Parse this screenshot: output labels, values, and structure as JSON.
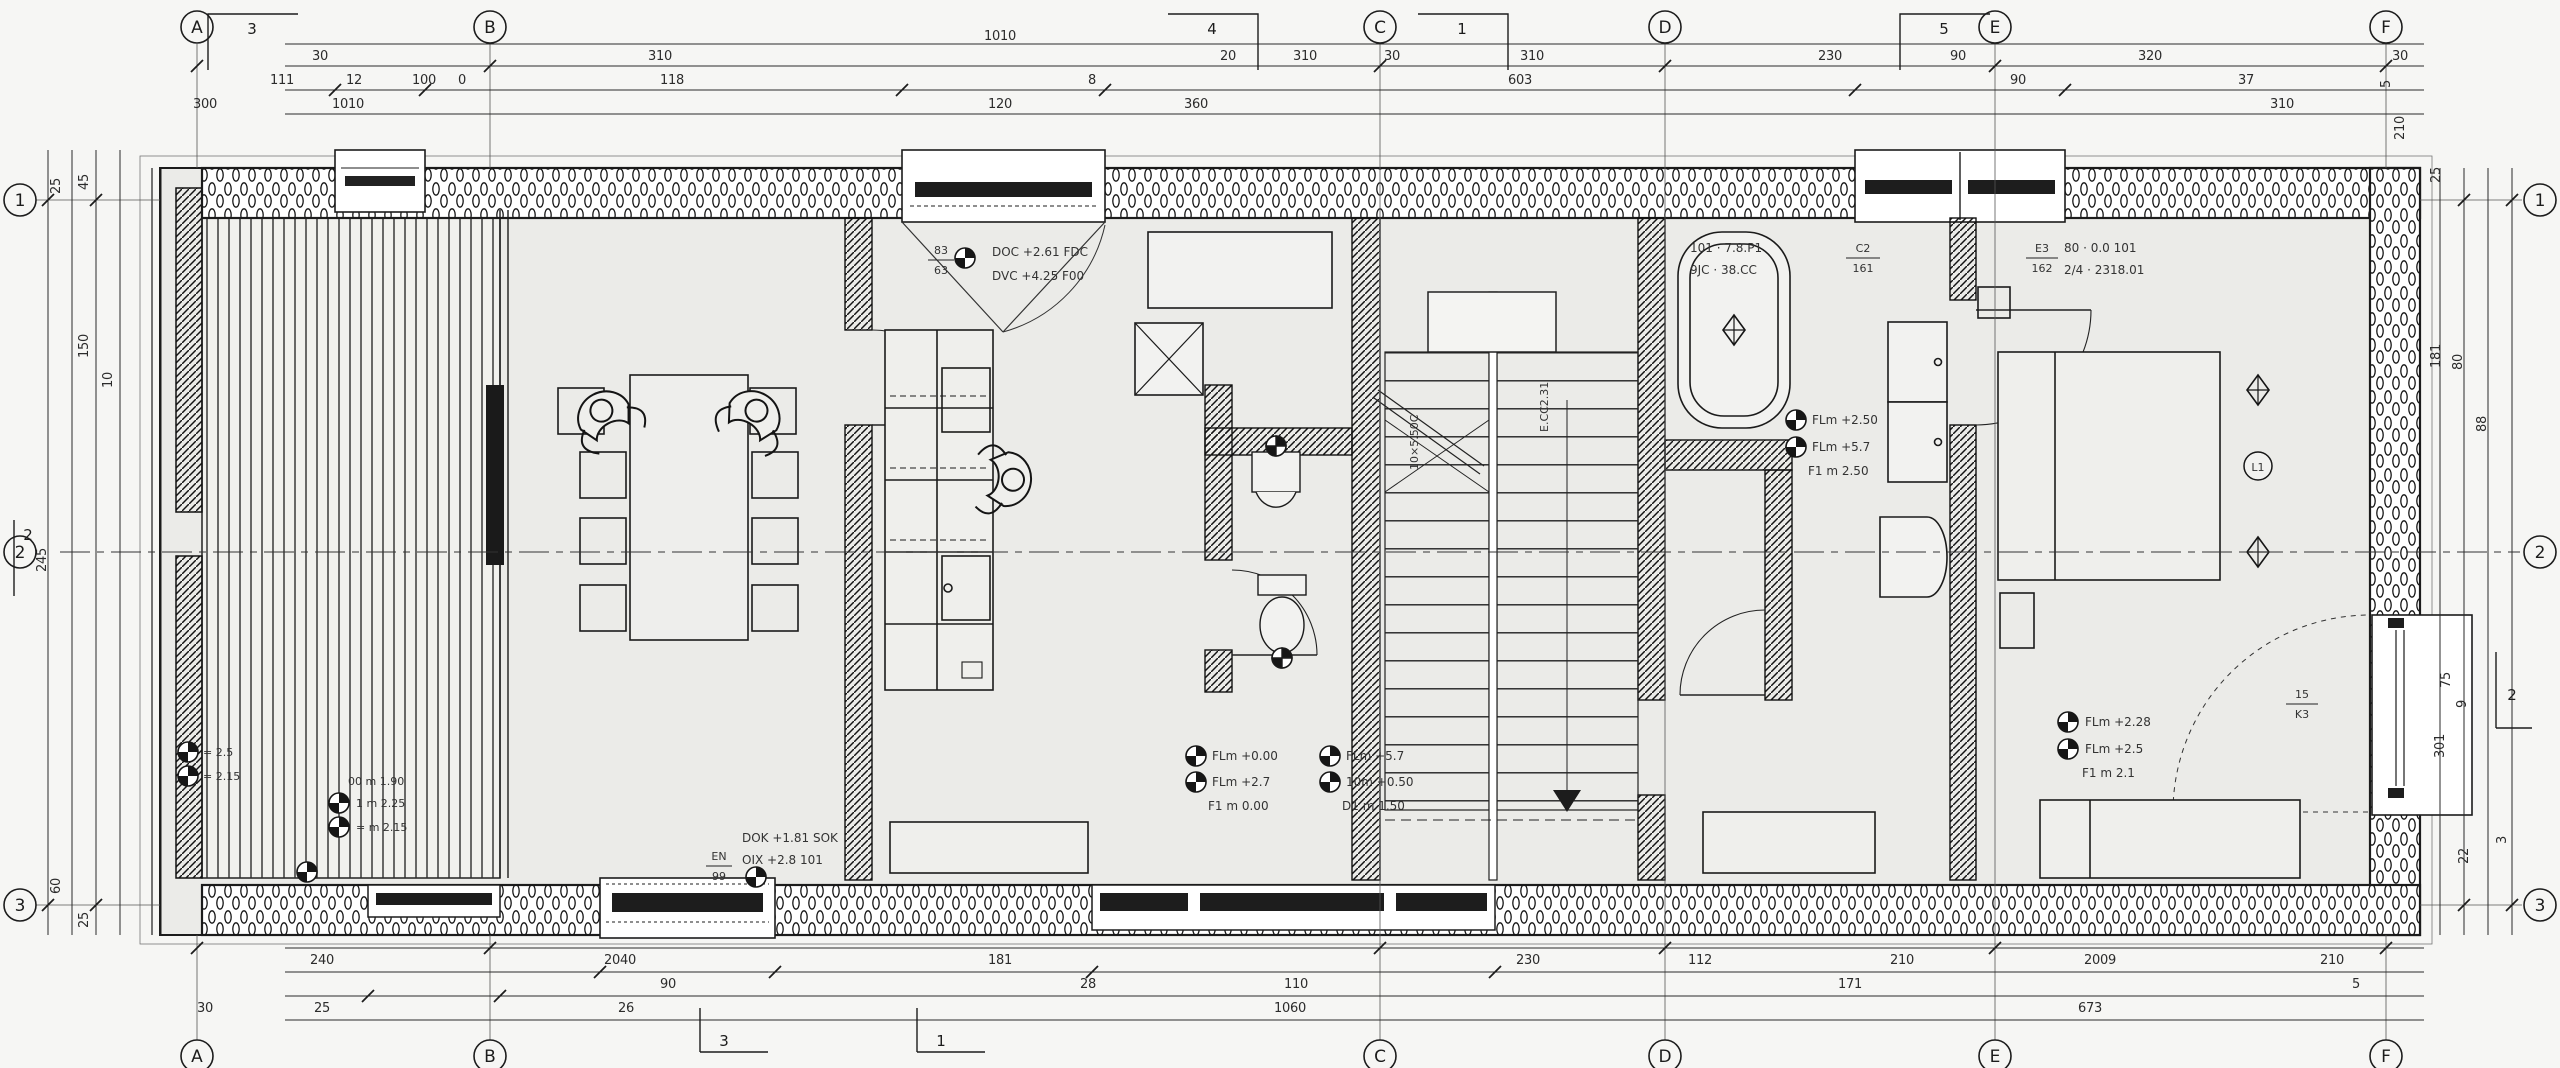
{
  "sheet": {
    "type": "architectural-floor-plan",
    "bg": "#f6f6f4",
    "floor": "#ebebe8",
    "ink": "#1c1c1c"
  },
  "grid": {
    "cols": [
      {
        "label": "A"
      },
      {
        "label": "B"
      },
      {
        "label": "C"
      },
      {
        "label": "D"
      },
      {
        "label": "E"
      },
      {
        "label": "F"
      }
    ],
    "rows": [
      {
        "label": "1"
      },
      {
        "label": "2"
      },
      {
        "label": "3"
      }
    ]
  },
  "flags": {
    "top": [
      "3",
      "4",
      "1",
      "5"
    ],
    "bottom": [
      "3",
      "1"
    ],
    "left": "2",
    "right": "2"
  },
  "dims": {
    "top_overall": "1010",
    "top_row1": [
      "30",
      "310",
      "20",
      "310",
      "30",
      "310",
      "230",
      "90",
      "320",
      "30"
    ],
    "top_row2": [
      "111",
      "12",
      "100",
      "0",
      "118",
      "8",
      "603",
      "90",
      "37"
    ],
    "top_row3": [
      "300",
      "1010",
      "120",
      "360",
      "310"
    ],
    "bottom_row1": [
      "240",
      "2040",
      "181",
      "230",
      "112",
      "210",
      "2009",
      "210"
    ],
    "bottom_row2": [
      "90",
      "28",
      "110",
      "171",
      "5"
    ],
    "bottom_row3": [
      "30",
      "25",
      "26",
      "1060",
      "673"
    ],
    "left": [
      "25",
      "45",
      "150",
      "10",
      "245",
      "60",
      "25"
    ],
    "right": [
      "5",
      "210",
      "25",
      "181",
      "80",
      "88",
      "75",
      "9",
      "301",
      "3",
      "22"
    ]
  },
  "ann": {
    "window_top": {
      "l1": "DOC +2.61 FDC",
      "l2": "DVC +4.25 F00"
    },
    "entry": {
      "l1": "DOK +1.81 SOK",
      "l2": "OIX +2.8 101"
    },
    "hall_a": {
      "l1": "FLm +0.00",
      "l2": "FLm +2.7",
      "l3": "F1 m 0.00"
    },
    "hall_b": {
      "l1": "FLm +5.7",
      "l2": "10m +0.50",
      "l3": "D1 m 1.50"
    },
    "bath": {
      "l1": "FLm +2.50",
      "l2": "FLm +5.7",
      "l3": "F1 m 2.50"
    },
    "bedroom": {
      "l1": "FLm +2.28",
      "l2": "FLm +2.5",
      "l3": "F1 m 2.1"
    },
    "living": {
      "l0": "00 m 1.90",
      "l1": "1 m 2.25",
      "l2": "= m 2.15"
    },
    "terrace": {
      "l1": "= 2.5",
      "l2": "= 2.15"
    }
  },
  "tags": {
    "bath_door": {
      "l1": "101 · 7.8.P1",
      "l2": "9JC · 38.CC",
      "num": "C2",
      "den": "161"
    },
    "bedroom_door": {
      "l1": "80 · 0.0 101",
      "l2": "2/4 · 2318.01",
      "num": "E3",
      "den": "162"
    },
    "bedroom_low": {
      "num": "15",
      "den": "K3"
    },
    "window": {
      "num": "83",
      "den": "63"
    },
    "entry": {
      "num": "EN",
      "den": "99"
    }
  },
  "stairs": {
    "left": "10×5.50C",
    "right": "E.CC2.31"
  },
  "markers": {
    "bedroom_circle": "L1"
  }
}
